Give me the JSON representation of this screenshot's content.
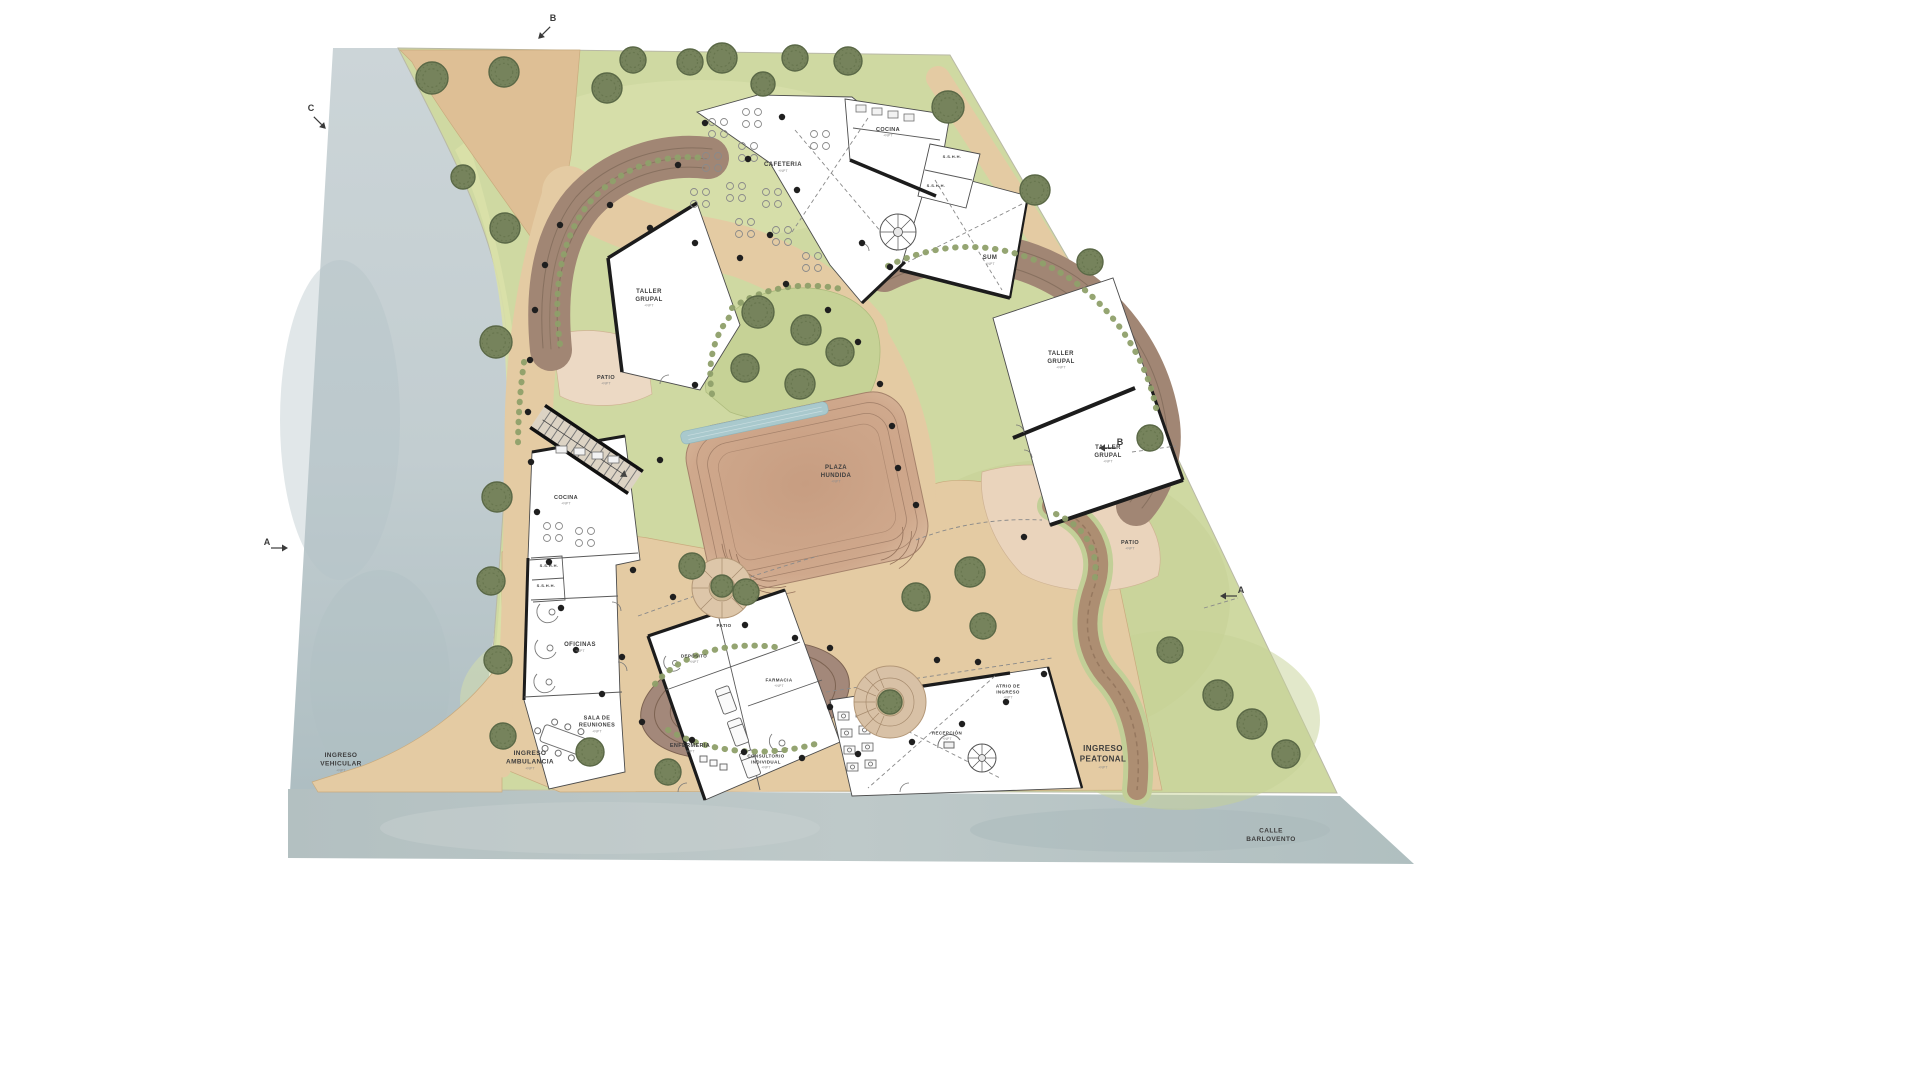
{
  "drawing": {
    "type": "architectural-site-plan",
    "street_name": "CALLE BARLOVENTO"
  },
  "colors": {
    "site_green": "#cfd9a2",
    "path_tan": "#e4cba3",
    "ramp_brown": "#a18674",
    "plaza_brown": "#c9a184",
    "water_blue": "#a9c9cd",
    "tree_green": "#76835c",
    "tree_edge": "#5a6846",
    "street_gray": "#b9c5c5",
    "riverside_gray": "#c6d0d3",
    "building": "#ffffff",
    "wall": "#1c1c1c",
    "label": "#3d3d3d",
    "dot": "#1f1f1f"
  },
  "plan": {
    "labels": [
      {
        "id": "cafeteria",
        "text": "CAFETERIA",
        "sub": "+NPT",
        "x": 783,
        "y": 167,
        "fs": 6
      },
      {
        "id": "cocina-top",
        "text": "COCINA",
        "sub": "+NPT",
        "x": 888,
        "y": 132,
        "fs": 5.5
      },
      {
        "id": "sshh-top-1",
        "text": "S.S.H.H.",
        "x": 952,
        "y": 157,
        "fs": 4
      },
      {
        "id": "sshh-top-2",
        "text": "S.S.H.H.",
        "x": 936,
        "y": 186,
        "fs": 4
      },
      {
        "id": "sum",
        "text": "SUM",
        "sub": "+NPT",
        "x": 990,
        "y": 260,
        "fs": 6
      },
      {
        "id": "taller-grupal-left",
        "text": "TALLER\nGRUPAL",
        "sub": "+NPT",
        "x": 649,
        "y": 298,
        "fs": 6
      },
      {
        "id": "patio-left",
        "text": "PATIO",
        "sub": "+NPT",
        "x": 606,
        "y": 380,
        "fs": 5.5
      },
      {
        "id": "cocina-left",
        "text": "COCINA",
        "sub": "+NPT",
        "x": 566,
        "y": 500,
        "fs": 5.5
      },
      {
        "id": "sshh-left-1",
        "text": "S.S.H.H.",
        "x": 549,
        "y": 566,
        "fs": 4
      },
      {
        "id": "sshh-left-2",
        "text": "S.S.H.H.",
        "x": 546,
        "y": 586,
        "fs": 4
      },
      {
        "id": "oficinas",
        "text": "OFICINAS",
        "sub": "+NPT",
        "x": 580,
        "y": 647,
        "fs": 6
      },
      {
        "id": "sala-de-reuniones",
        "text": "SALA DE\nREUNIONES",
        "sub": "+NPT",
        "x": 597,
        "y": 724,
        "fs": 5.5
      },
      {
        "id": "deposito",
        "text": "DEPÓSITO",
        "sub": "+NPT",
        "x": 694,
        "y": 659,
        "fs": 4.5
      },
      {
        "id": "farmacia",
        "text": "FARMACIA",
        "sub": "+NPT",
        "x": 779,
        "y": 683,
        "fs": 4.5
      },
      {
        "id": "enfermeria",
        "text": "ENFERMERIA",
        "sub": "+NPT",
        "x": 690,
        "y": 748,
        "fs": 5.5
      },
      {
        "id": "consultorio-individual",
        "text": "CONSULTORIO\nINDIVIDUAL",
        "sub": "+NPT",
        "x": 766,
        "y": 762,
        "fs": 4.5
      },
      {
        "id": "plaza-hundida",
        "text": "PLAZA\nHUNDIDA",
        "sub": "+NPT",
        "x": 836,
        "y": 474,
        "fs": 6
      },
      {
        "id": "patio-center",
        "text": "PATIO",
        "x": 724,
        "y": 626,
        "fs": 4.5
      },
      {
        "id": "taller-grupal-right-1",
        "text": "TALLER\nGRUPAL",
        "sub": "+NPT",
        "x": 1061,
        "y": 360,
        "fs": 6
      },
      {
        "id": "taller-grupal-right-2",
        "text": "TALLER\nGRUPAL",
        "sub": "+NPT",
        "x": 1108,
        "y": 454,
        "fs": 6
      },
      {
        "id": "patio-right",
        "text": "PATIO",
        "sub": "+NPT",
        "x": 1130,
        "y": 545,
        "fs": 5.5
      },
      {
        "id": "atrio-de-ingreso",
        "text": "ATRIO DE\nINGRESO",
        "sub": "+NPT",
        "x": 1008,
        "y": 692,
        "fs": 4.5
      },
      {
        "id": "recepcion",
        "text": "RECEPCIÓN",
        "sub": "+NPT",
        "x": 947,
        "y": 736,
        "fs": 4.5
      },
      {
        "id": "ingreso-vehicular",
        "text": "INGRESO\nVEHICULAR",
        "sub": "+NPT",
        "x": 341,
        "y": 762,
        "fs": 6.5
      },
      {
        "id": "ingreso-ambulancia",
        "text": "INGRESO\nAMBULANCIA",
        "sub": "+NPT",
        "x": 530,
        "y": 760,
        "fs": 6.5
      },
      {
        "id": "ingreso-peatonal",
        "text": "INGRESO\nPEATONAL",
        "sub": "+NPT",
        "x": 1103,
        "y": 757,
        "fs": 8
      },
      {
        "id": "calle-barlovento",
        "text": "CALLE\nBARLOVENTO",
        "x": 1271,
        "y": 835,
        "fs": 6.5
      }
    ],
    "section_markers": [
      {
        "letter": "B",
        "x": 553,
        "y": 24,
        "angle": 45
      },
      {
        "letter": "C",
        "x": 311,
        "y": 114,
        "angle": 315
      },
      {
        "letter": "B",
        "x": 1120,
        "y": 448,
        "angle": 90
      },
      {
        "letter": "A",
        "x": 267,
        "y": 548,
        "angle": 270
      },
      {
        "letter": "A",
        "x": 1241,
        "y": 596,
        "angle": 90
      }
    ],
    "trees": [
      [
        432,
        78,
        16
      ],
      [
        504,
        72,
        15
      ],
      [
        607,
        88,
        15
      ],
      [
        633,
        60,
        13
      ],
      [
        690,
        62,
        13
      ],
      [
        722,
        58,
        15
      ],
      [
        763,
        84,
        12
      ],
      [
        795,
        58,
        13
      ],
      [
        848,
        61,
        14
      ],
      [
        948,
        107,
        16
      ],
      [
        1035,
        190,
        15
      ],
      [
        1090,
        262,
        13
      ],
      [
        1150,
        438,
        13
      ],
      [
        463,
        177,
        12
      ],
      [
        505,
        228,
        15
      ],
      [
        496,
        342,
        16
      ],
      [
        497,
        497,
        15
      ],
      [
        491,
        581,
        14
      ],
      [
        498,
        660,
        14
      ],
      [
        503,
        736,
        13
      ],
      [
        758,
        312,
        16
      ],
      [
        806,
        330,
        15
      ],
      [
        745,
        368,
        14
      ],
      [
        800,
        384,
        15
      ],
      [
        840,
        352,
        14
      ],
      [
        692,
        566,
        13
      ],
      [
        746,
        592,
        13
      ],
      [
        970,
        572,
        15
      ],
      [
        916,
        597,
        14
      ],
      [
        983,
        626,
        13
      ],
      [
        590,
        752,
        14
      ],
      [
        668,
        772,
        13
      ],
      [
        1218,
        695,
        15
      ],
      [
        1252,
        724,
        15
      ],
      [
        1286,
        754,
        14
      ],
      [
        1170,
        650,
        13
      ],
      [
        722,
        586,
        11
      ],
      [
        890,
        702,
        12
      ]
    ],
    "dots": [
      [
        610,
        205
      ],
      [
        650,
        228
      ],
      [
        695,
        243
      ],
      [
        740,
        258
      ],
      [
        786,
        284
      ],
      [
        828,
        310
      ],
      [
        858,
        342
      ],
      [
        880,
        384
      ],
      [
        892,
        426
      ],
      [
        898,
        468
      ],
      [
        560,
        225
      ],
      [
        545,
        265
      ],
      [
        535,
        310
      ],
      [
        530,
        360
      ],
      [
        528,
        412
      ],
      [
        531,
        462
      ],
      [
        537,
        512
      ],
      [
        549,
        562
      ],
      [
        561,
        608
      ],
      [
        576,
        650
      ],
      [
        602,
        694
      ],
      [
        642,
        722
      ],
      [
        692,
        740
      ],
      [
        744,
        752
      ],
      [
        802,
        758
      ],
      [
        858,
        754
      ],
      [
        912,
        742
      ],
      [
        962,
        724
      ],
      [
        1006,
        702
      ],
      [
        1044,
        674
      ],
      [
        705,
        123
      ],
      [
        678,
        165
      ],
      [
        782,
        117
      ],
      [
        748,
        159
      ],
      [
        797,
        190
      ],
      [
        862,
        243
      ],
      [
        890,
        267
      ],
      [
        770,
        235
      ],
      [
        695,
        385
      ],
      [
        660,
        460
      ],
      [
        633,
        570
      ],
      [
        673,
        597
      ],
      [
        745,
        625
      ],
      [
        622,
        657
      ],
      [
        795,
        638
      ],
      [
        830,
        648
      ],
      [
        937,
        660
      ],
      [
        978,
        662
      ],
      [
        830,
        707
      ],
      [
        1024,
        537
      ],
      [
        916,
        505
      ]
    ]
  }
}
